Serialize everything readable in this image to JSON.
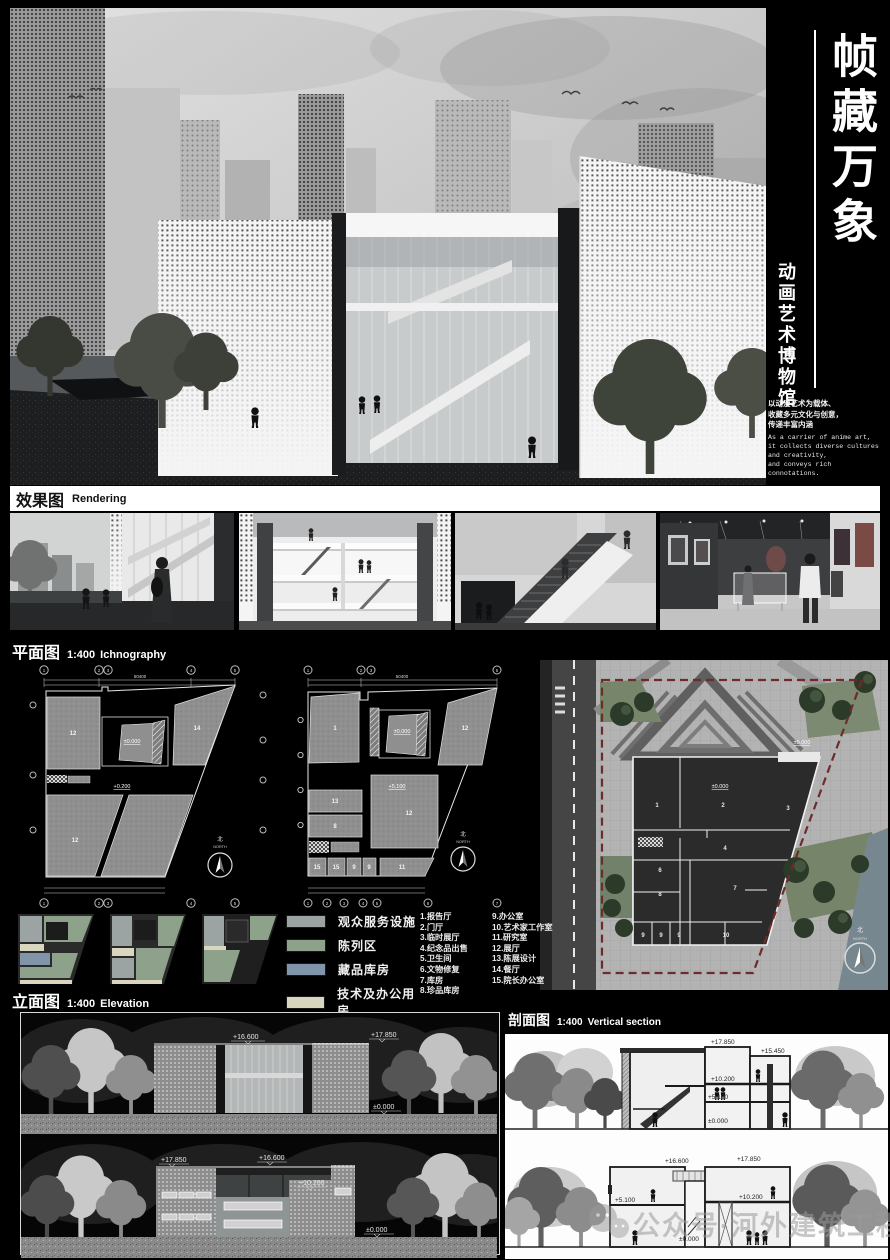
{
  "header": {
    "title": "帧藏万象",
    "subtitle": "动画艺术博物馆",
    "intro_cn": [
      "以动漫艺术为载体、",
      "收藏多元文化与创意，",
      "传递丰富内涵"
    ],
    "intro_en": [
      "As a carrier of anime art,",
      "it collects diverse cultures",
      "and creativity,",
      "and conveys rich connotations."
    ]
  },
  "sections": {
    "rendering_cn": "效果图",
    "rendering_en": "Rendering",
    "plan_cn": "平面图",
    "plan_scale": "1:400",
    "plan_en": "Ichnography",
    "elevation_cn": "立面图",
    "elevation_scale": "1:400",
    "elevation_en": "Elevation",
    "section_cn": "剖面图",
    "section_scale": "1:400",
    "section_en": "Vertical section"
  },
  "legend": {
    "zones": [
      {
        "label": "观众服务设施",
        "color": "#9ba3a3"
      },
      {
        "label": "陈列区",
        "color": "#8ea28b"
      },
      {
        "label": "藏品库房",
        "color": "#8095aa"
      },
      {
        "label": "技术及办公用房",
        "color": "#d9d6c0"
      }
    ],
    "rooms_col1": [
      "1.报告厅",
      "2.门厅",
      "3.临时展厅",
      "4.纪念品出售",
      "5.卫生间",
      "6.文物修复",
      "7.库房",
      "8.珍品库房"
    ],
    "rooms_col2": [
      "9.办公室",
      "10.艺术家工作室",
      "11.研究室",
      "12.展厅",
      "13.陈展设计",
      "14.餐厅",
      "15.院长办公室"
    ]
  },
  "plans": {
    "north_cn": "北",
    "north_en": "NORTH",
    "plan1": {
      "rooms": [
        "12",
        "14",
        "12"
      ],
      "levels": [
        "±0.000",
        "+0.200"
      ],
      "total_dim": "50400",
      "grid": [
        "1",
        "2",
        "3",
        "4",
        "5"
      ]
    },
    "plan2": {
      "rooms": [
        "1",
        "12",
        "13",
        "8",
        "12",
        "15",
        "15",
        "9",
        "9",
        "11"
      ],
      "levels": [
        "±0.000",
        "+5.100"
      ],
      "total_dim": "50400",
      "grid_top": [
        "1",
        "2",
        "3",
        "5"
      ],
      "grid_bottom": [
        "1",
        "2",
        "3",
        "4",
        "5",
        "6",
        "7"
      ]
    },
    "site": {
      "rooms": [
        "1",
        "2",
        "3",
        "4",
        "6",
        "8",
        "7",
        "9",
        "9",
        "9",
        "10"
      ],
      "levels": [
        "±0.000",
        "±0.000"
      ]
    }
  },
  "elevations": {
    "south": {
      "levels": [
        "+16.600",
        "+17.850",
        "±0.000"
      ]
    },
    "north": {
      "levels": [
        "+17.850",
        "+16.600",
        "+10.200",
        "±0.000"
      ]
    }
  },
  "sections_drawings": {
    "s1": {
      "levels": [
        "+17.850",
        "+15.450",
        "+10.200",
        "+5.100",
        "±0.000"
      ]
    },
    "s2": {
      "levels": [
        "+16.600",
        "+17.850",
        "+10.200",
        "+5.100",
        "±0.000"
      ]
    }
  },
  "watermark": {
    "text": "公众号·河外建筑工程"
  }
}
